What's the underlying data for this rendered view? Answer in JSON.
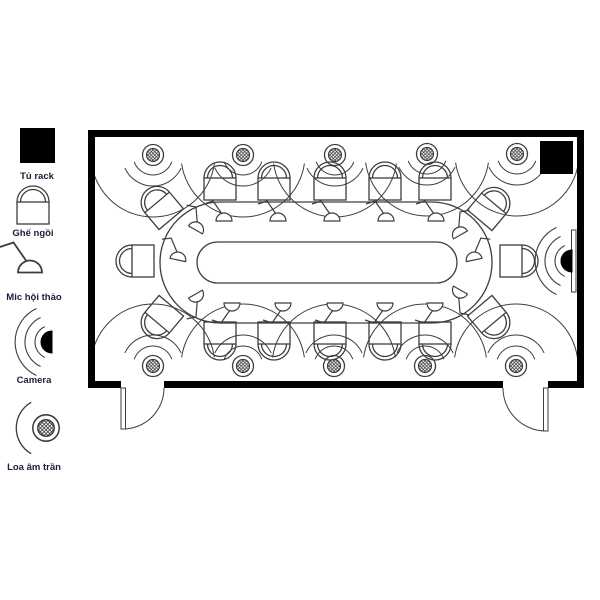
{
  "colors": {
    "wall": "#000000",
    "line": "#3d3d3d",
    "solid": "#000000",
    "text": "#1d1d3a",
    "bg": "#ffffff"
  },
  "legend": {
    "items": [
      {
        "key": "rack",
        "label": "Tủ rack"
      },
      {
        "key": "chair",
        "label": "Ghế ngồi"
      },
      {
        "key": "mic",
        "label": "Mic hội thảo"
      },
      {
        "key": "camera",
        "label": "Camera"
      },
      {
        "key": "speaker",
        "label": "Loa âm trần"
      }
    ]
  },
  "room": {
    "x": 88,
    "y": 130,
    "w": 496,
    "h": 258,
    "wall": 7
  },
  "rack_unit": {
    "x": 540,
    "y": 141,
    "w": 33,
    "h": 33
  },
  "table": {
    "outer": [
      160,
      202,
      332,
      121
    ],
    "inner": [
      197,
      242,
      260,
      41
    ]
  },
  "wall_display": [
    571.5,
    230,
    4.5,
    62
  ],
  "camera_pos": [
    572,
    261
  ],
  "doors": [
    {
      "gap": [
        121,
        164
      ],
      "hinge": "left"
    },
    {
      "gap": [
        503,
        548
      ],
      "hinge": "right"
    }
  ],
  "speakers": [
    [
      153,
      155,
      0
    ],
    [
      243,
      155,
      0
    ],
    [
      335,
      155,
      0
    ],
    [
      427,
      154,
      0
    ],
    [
      517,
      154,
      0
    ],
    [
      153,
      366,
      180
    ],
    [
      243,
      366,
      180
    ],
    [
      334,
      366,
      180
    ],
    [
      425,
      366,
      180
    ],
    [
      516,
      366,
      180
    ]
  ],
  "chairs": [
    [
      220,
      184,
      0
    ],
    [
      274,
      184,
      0
    ],
    [
      330,
      184,
      0
    ],
    [
      385,
      184,
      0
    ],
    [
      435,
      184,
      0
    ],
    [
      161,
      207,
      -40
    ],
    [
      490,
      208,
      40
    ],
    [
      138,
      261,
      -90
    ],
    [
      516,
      261,
      90
    ],
    [
      161,
      318,
      220
    ],
    [
      490,
      318,
      140
    ],
    [
      220,
      338,
      180
    ],
    [
      274,
      338,
      180
    ],
    [
      330,
      338,
      180
    ],
    [
      385,
      338,
      180
    ],
    [
      435,
      338,
      180
    ]
  ],
  "mics": [
    [
      224,
      220,
      0,
      1,
      1
    ],
    [
      278,
      220,
      0,
      1,
      1
    ],
    [
      332,
      220,
      0,
      1,
      1
    ],
    [
      386,
      220,
      0,
      1,
      1
    ],
    [
      436,
      220,
      0,
      1,
      1
    ],
    [
      196,
      229,
      30,
      1,
      1
    ],
    [
      460,
      234,
      -30,
      -1,
      1
    ],
    [
      178,
      259,
      12,
      1,
      1
    ],
    [
      474,
      259,
      -12,
      -1,
      1
    ],
    [
      232,
      304,
      0,
      1,
      -1
    ],
    [
      283,
      304,
      0,
      1,
      -1
    ],
    [
      335,
      304,
      0,
      1,
      -1
    ],
    [
      385,
      304,
      0,
      1,
      -1
    ],
    [
      435,
      304,
      0,
      1,
      -1
    ],
    [
      196,
      295,
      -30,
      1,
      -1
    ],
    [
      460,
      291,
      30,
      -1,
      -1
    ]
  ]
}
